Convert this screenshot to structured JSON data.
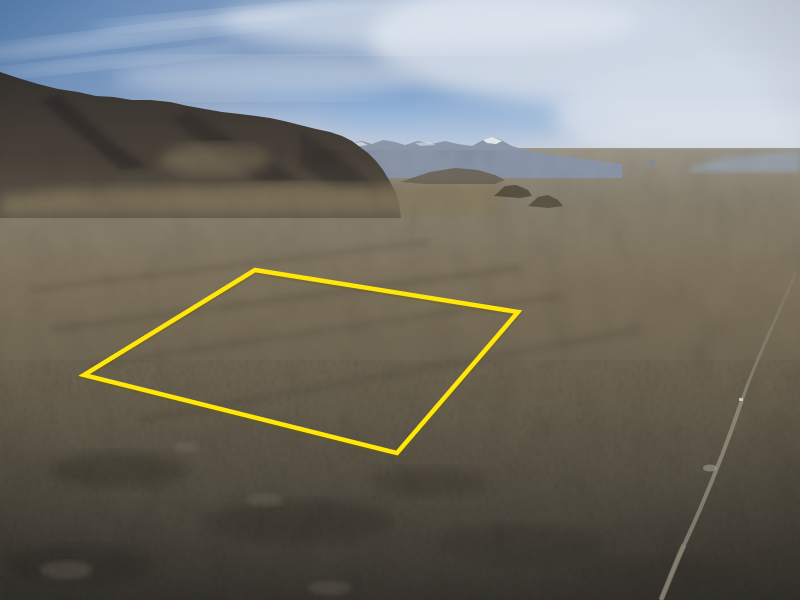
{
  "scene": {
    "kind": "aerial-photograph",
    "description": "Drone photo of a high-desert valley: dark mountain range descending from the upper left, hazy snow-capped peaks in the far distance, tan sagebrush flats, a dirt track crossing the lower right, and a land parcel outlined in yellow on the valley floor. No text is visible in the image."
  },
  "palette": {
    "sky_top": "#5b84b6",
    "sky_mid": "#87a0c2",
    "sky_haze": "#bdc8d6",
    "sky_low_blue": "#7ba3d0",
    "cloud": "#d3dce8",
    "cloud_bright": "#e4eaf2",
    "distant_range": "#8b96a9",
    "snow": "#eaeef2",
    "far_hills": "#9aa4b1",
    "mountain_dark": "#35322f",
    "mountain_mid": "#5e564a",
    "foothill_tan": "#86795d",
    "sunlit_fan": "#8d7f63",
    "valley_far": "#9b9689",
    "valley_mid": "#7d725c",
    "valley_low": "#6a614f",
    "fg_dark": "#514c41",
    "fg_bottom": "#393630",
    "road": "#938d7d",
    "vehicle_dot": "#d2ccbd"
  },
  "boundary": {
    "name": "parcel-boundary",
    "color": "#ffe70a",
    "shadow_color": "#6e5c00",
    "stroke_width": "4.5",
    "points_attr": "255,270 518,312 397,453 84,375",
    "corners": [
      {
        "x": 255,
        "y": 270
      },
      {
        "x": 518,
        "y": 312
      },
      {
        "x": 397,
        "y": 453
      },
      {
        "x": 84,
        "y": 375
      }
    ]
  },
  "road": {
    "name": "dirt-track",
    "path_upper": "M796,272 C778,316 757,357 742,400",
    "path_lower": "M742,400 C727,444 706,498 684,545 C676,562 669,581 661,600",
    "pullout_x": 710,
    "pullout_y": 468,
    "vehicle_x": 739,
    "vehicle_y": 398
  },
  "landmarks": {
    "main_ridge": "dark rocky range upper-left, crest from (0,72) to (345,140)",
    "snowy_peak": {
      "x": 492,
      "y": 138
    },
    "small_butte_1": {
      "x": 512,
      "y": 190
    },
    "small_butte_2": {
      "x": 545,
      "y": 200
    },
    "distant_cone": {
      "x": 651,
      "y": 160
    },
    "horizon_right_y": 160
  }
}
